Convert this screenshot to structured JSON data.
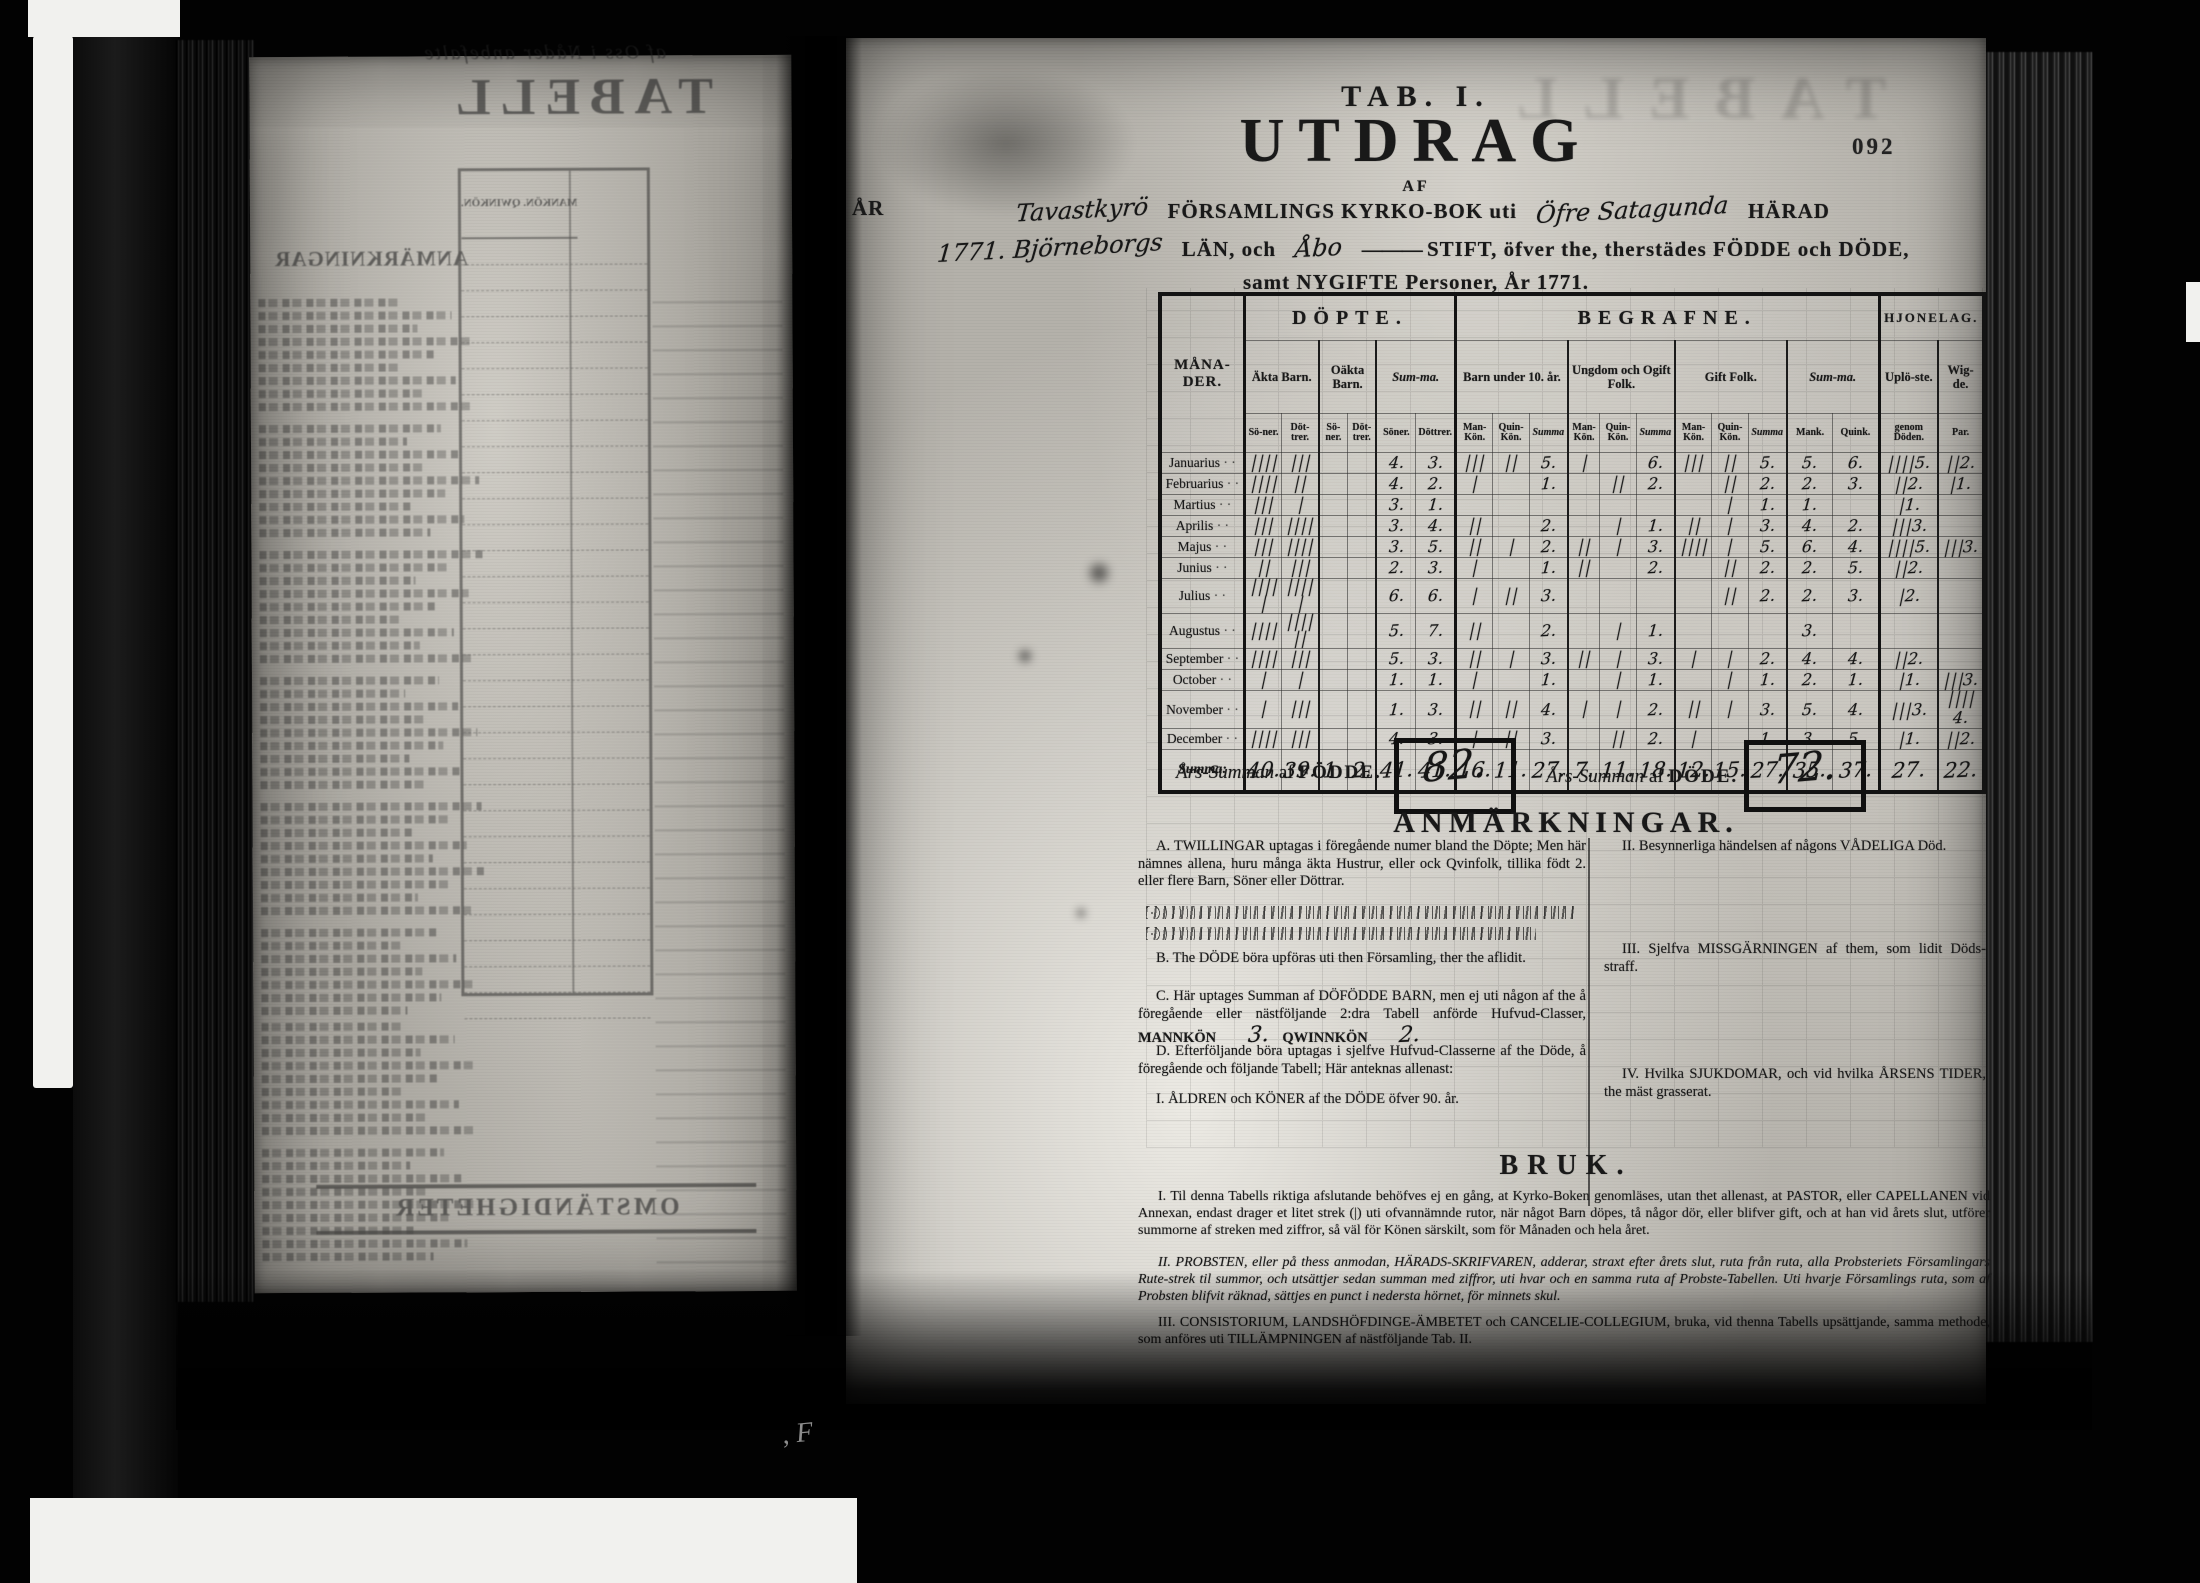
{
  "film": {
    "page_number": "092",
    "stray_mark": ", F"
  },
  "left_page": {
    "ghost_topline": "af Oss i Nåder anbefalte",
    "ghost_title": "TABELL",
    "ghost_heading": "ANMÄRKNINGAR",
    "ghost_table_header": "MANKÖN. QWINKÖN.",
    "ghost_footer": "OMSTÄNDIGHETER"
  },
  "right_page": {
    "title": {
      "tab": "TAB. I.",
      "main": "UTDRAG",
      "af": "AF",
      "ar": "ÅR",
      "hw_parish": "Tavastkyrö",
      "l1a": "FÖRSAMLINGS KYRKO-BOK uti",
      "hw_harad": "Öfre Satagunda",
      "l1b": "HÄRAD",
      "hw_lan": "1771. Björneborgs",
      "l2a": "LÄN, och",
      "hw_stift": "Åbo",
      "l2rule": "———",
      "l2b": "STIFT, öfver the, therstädes FÖDDE och DÖDE,",
      "l3": "samt NYGIFTE Personer, År 1771."
    },
    "table": {
      "col_groups": [
        {
          "label": "MÅNA-DER."
        },
        {
          "label": "DÖPTE.",
          "subs": [
            {
              "label": "Äkta Barn.",
              "cols": [
                "Sö-ner.",
                "Döt-trer."
              ]
            },
            {
              "label": "Oäkta Barn.",
              "cols": [
                "Sö-ner.",
                "Döt-trer."
              ]
            },
            {
              "label": "Sum-ma.",
              "italic": true,
              "cols": [
                "Söner.",
                "Döttrer."
              ]
            }
          ]
        },
        {
          "label": "BEGRAFNE.",
          "subs": [
            {
              "label": "Barn under 10. år.",
              "cols": [
                "Man-Kön.",
                "Quin-Kön.",
                "Summa"
              ]
            },
            {
              "label": "Ungdom och Ogift Folk.",
              "cols": [
                "Man-Kön.",
                "Quin-Kön.",
                "Summa"
              ]
            },
            {
              "label": "Gift Folk.",
              "cols": [
                "Man-Kön.",
                "Quin-Kön.",
                "Summa"
              ]
            },
            {
              "label": "Sum-ma.",
              "italic": true,
              "cols": [
                "Mank.",
                "Quink."
              ]
            }
          ]
        },
        {
          "label": "HJONELAG.",
          "small": true,
          "subs": [
            {
              "label": "Uplö-ste.",
              "cols": [
                "genom Döden."
              ]
            },
            {
              "label": "Wig-de.",
              "cols": [
                "Par."
              ]
            }
          ]
        }
      ],
      "months": [
        "Januarius",
        "Februarius",
        "Martius",
        "Aprilis",
        "Majus",
        "Junius",
        "Julius",
        "Augustus",
        "September",
        "October",
        "November",
        "December"
      ],
      "rows": [
        [
          "||||",
          "|||",
          "",
          "",
          "4.",
          "3.",
          "|||",
          "||",
          "5.",
          "|",
          "",
          "6.",
          "|||",
          "||",
          "5.",
          "5.",
          "6.",
          "|||| 5.",
          "|| 2."
        ],
        [
          "||||",
          "||",
          "",
          "",
          "4.",
          "2.",
          "|",
          "",
          "1.",
          "",
          "||",
          "2.",
          "",
          "||",
          "2.",
          "2.",
          "3.",
          "|| 2.",
          "| 1."
        ],
        [
          "|||",
          "|",
          "",
          "",
          "3.",
          "1.",
          "",
          "",
          "",
          "",
          "",
          "",
          "",
          "|",
          "1.",
          "1.",
          "",
          "| 1.",
          ""
        ],
        [
          "|||",
          "||||",
          "",
          "",
          "3.",
          "4.",
          "||",
          "",
          "2.",
          "",
          "|",
          "1.",
          "||",
          "|",
          "3.",
          "4.",
          "2.",
          "||| 3.",
          ""
        ],
        [
          "|||",
          "||||",
          "",
          "",
          "3.",
          "5.",
          "||",
          "|",
          "2.",
          "||",
          "|",
          "3.",
          "||||",
          "|",
          "5.",
          "6.",
          "4.",
          "|||| 5.",
          "||| 3."
        ],
        [
          "||",
          "|||",
          "",
          "",
          "2.",
          "3.",
          "|",
          "",
          "1.",
          "||",
          "",
          "2.",
          "",
          "||",
          "2.",
          "2.",
          "5.",
          "|| 2.",
          ""
        ],
        [
          "|||| |",
          "|||| |",
          "",
          "",
          "6.",
          "6.",
          "|",
          "||",
          "3.",
          "",
          "",
          "",
          "",
          "||",
          "2.",
          "2.",
          "3.",
          "| 2.",
          ""
        ],
        [
          "||||",
          "|||| ||",
          "",
          "",
          "5.",
          "7.",
          "||",
          "",
          "2.",
          "",
          "|",
          "1.",
          "",
          "",
          "",
          "3.",
          "",
          "",
          ""
        ],
        [
          "||||",
          "|||",
          "",
          "",
          "5.",
          "3.",
          "||",
          "|",
          "3.",
          "||",
          "|",
          "3.",
          "|",
          "|",
          "2.",
          "4.",
          "4.",
          "|| 2.",
          ""
        ],
        [
          "|",
          "|",
          "",
          "",
          "1.",
          "1.",
          "|",
          "",
          "1.",
          "",
          "|",
          "1.",
          "",
          "|",
          "1.",
          "2.",
          "1.",
          "| 1.",
          "||| 3."
        ],
        [
          "|",
          "|||",
          "",
          "",
          "1.",
          "3.",
          "||",
          "||",
          "4.",
          "|",
          "|",
          "2.",
          "||",
          "|",
          "3.",
          "5.",
          "4.",
          "||| 3.",
          "|||| 4."
        ],
        [
          "||||",
          "|||",
          "",
          "",
          "4.",
          "3.",
          "|",
          "||",
          "3.",
          "",
          "||",
          "2.",
          "|",
          "",
          "1.",
          "3.",
          "5.",
          "| 1.",
          "|| 2."
        ]
      ],
      "summa_label": "Summa:",
      "summa_row": [
        "40.",
        "39.",
        "1.",
        "2.",
        "41.",
        "41.",
        "16.",
        "11.",
        "27.",
        "7.",
        "11.",
        "18.",
        "12.",
        "15.",
        "27.",
        "35.",
        "37.",
        "27.",
        "22."
      ]
    },
    "year_summary": {
      "fodde_label_pre": "Års-Summan",
      "fodde_label_af": "af",
      "fodde_label_word": "FÖDDE.",
      "fodde_value": "82.",
      "dode_label_pre": "Års-Summan",
      "dode_label_af": "af",
      "dode_label_word": "DÖDE.",
      "dode_value": "72."
    },
    "anmarkningar": {
      "heading": "ANMÄRKNINGAR.",
      "left_items": [
        {
          "id": "A",
          "text": "A. TWILLINGAR uptagas i föregående numer bland the Döpte; Men här nämnes allena, huru många äkta Hustrur, eller ock Qvinfolk, tillika födt 2. eller flere Barn, Söner eller Döttrar.",
          "hw_lines": 2
        },
        {
          "id": "B",
          "text": "B. The DÖDE böra upföras uti then Församling, ther the aflidit."
        },
        {
          "id": "C",
          "text": "C. Här uptages Summan af DÖFÖDDE BARN, men ej uti någon af the å föregående eller nästföljande 2:dra Tabell anförde Hufvud-Classer,",
          "c_labels": [
            "MANNKÖN",
            "QWINNKÖN"
          ],
          "c_values": [
            "3.",
            "2."
          ]
        },
        {
          "id": "D",
          "text": "D. Efterföljande böra uptagas i sjelfve Hufvud-Classerne af the Döde, å föregående och följande Tabell; Här anteknas allenast:"
        },
        {
          "id": "I",
          "text": "I. ÅLDREN och KÖNER af the DÖDE öfver 90. år."
        }
      ],
      "right_items": [
        {
          "id": "II",
          "text": "II. Besynnerliga händelsen af någons VÅDELIGA Död."
        },
        {
          "id": "III",
          "text": "III. Sjelfva MISSGÄRNINGEN af them, som lidit Döds-straff."
        },
        {
          "id": "IV",
          "text": "IV. Hvilka SJUKDOMAR, och vid hvilka ÅRSENS TIDER, the mäst grasserat."
        }
      ]
    },
    "bruk": {
      "heading": "BRUK.",
      "paragraphs": [
        {
          "text": "I. Til denna Tabells riktiga afslutande behöfves ej en gång, at Kyrko-Boken genomläses, utan thet allenast, at PASTOR, eller CAPELLANEN vid Annexan, endast drager et litet strek (|) uti ofvannämnde rutor, när något Barn döpes, tå någor dör, eller blifver gift, och at han vid årets slut, utförer summorne af streken med ziffror, så väl för Könen särskilt, som för Månaden och hela året.",
          "italic": false
        },
        {
          "text": "II. PROBSTEN, eller på thess anmodan, HÄRADS-SKRIFVAREN, adderar, straxt efter årets slut, ruta från ruta, alla Probsteriets Församlingars Rute-strek til summor, och utsättjer sedan summan med ziffror, uti hvar och en samma ruta af Probste-Tabellen. Uti hvarje Församlings ruta, som af Probsten blifvit räknad, sättjes en punct i nedersta hörnet, för minnets skul.",
          "italic": true
        },
        {
          "text": "III. CONSISTORIUM, LANDSHÖFDINGE-ÄMBETET och CANCELIE-COLLEGIUM, bruka, vid thenna Tabells upsättjande, samma methode, som anföres uti TILLÄMPNINGEN af nästföljande Tab. II.",
          "italic": false
        }
      ]
    }
  }
}
